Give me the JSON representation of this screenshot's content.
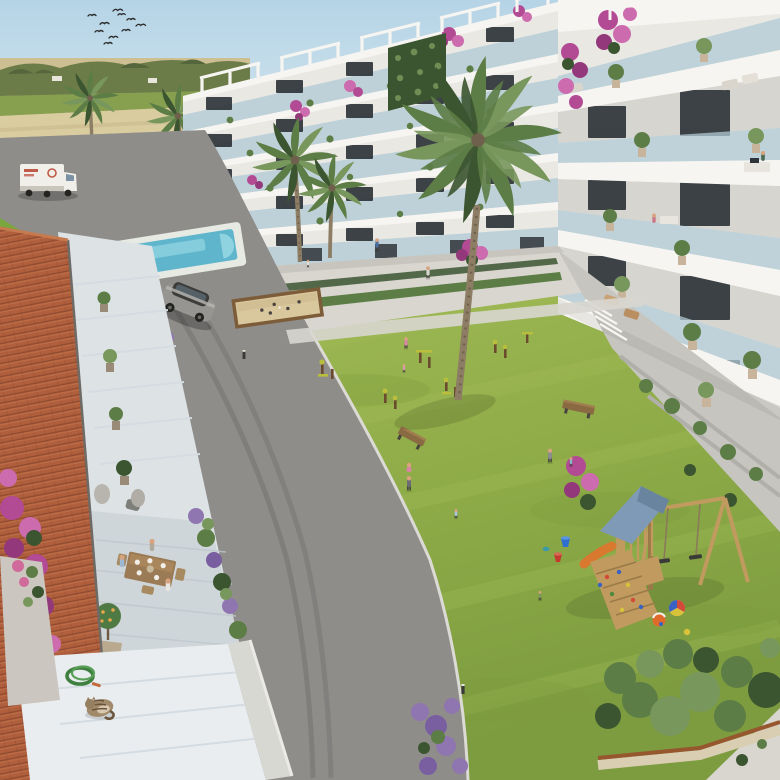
{
  "scene": {
    "type": "architectural-rendering",
    "description": "Aerial 3D visualization of a Mediterranean apartment complex: white modern blocks with glass balconies wrap a large lawn courtyard with palm trees, outdoor gym, bocce court, wooden playground, swimming pool, curving asphalt road with an SUV and delivery truck, farmland horizon with a flock of birds, and a foreground terracotta-roof terrace where three people dine; a cat sleeps beside a coiled garden hose.",
    "objects": [
      "flock-of-birds",
      "wheat-fields",
      "tree-line",
      "cypress-hedge",
      "distant-palms",
      "delivery-truck",
      "ornamental-garden",
      "swimming-pool",
      "swimmers",
      "apartment-building-left-wing",
      "apartment-building-right-wing",
      "roof-pergolas",
      "bougainvillea",
      "balcony-residents",
      "ground-terraces",
      "asphalt-road",
      "suv-car",
      "bocce-court",
      "courtyard-lawn",
      "outdoor-gym-stations",
      "wooden-benches",
      "residents-on-lawn",
      "playground-tower",
      "swing-set",
      "climbing-wall",
      "slide",
      "beach-balls",
      "buckets",
      "shrub-border",
      "lavender",
      "terracotta-roof",
      "dining-terrace",
      "diners",
      "citrus-tree-pot",
      "garden-hose",
      "sleeping-cat",
      "big-palm-tree"
    ],
    "counts": {
      "birds": 10,
      "people_visible": 18,
      "palm_trees": 6,
      "exercise_stations": 6,
      "benches": 2
    }
  },
  "colors": {
    "sky": "#b5d4e6",
    "skyHorizon": "#d9e8ef",
    "fieldTan": "#cdbf92",
    "fieldTanLight": "#d9cc9f",
    "fieldGreen": "#87a050",
    "treeline": "#6c7c49",
    "treelineDark": "#55663c",
    "cypress": "#3c5a33",
    "cypressDark": "#2e4a28",
    "road": "#8e8d8a",
    "roadTop": "#9f9e9b",
    "roadDark": "#73726f",
    "curb": "#dcdad4",
    "gardenGrass": "#7aa63e",
    "hedgeSwirl": "#5d8c31",
    "swirlPath": "#cfdc9f",
    "pool": "#5fb6cc",
    "poolLight": "#8fd2e0",
    "poolDeck": "#e7e9e3",
    "white": "#f6f5f1",
    "wall": "#e9e8e3",
    "wallShade": "#d6d5cf",
    "glass": "#b2cbd6",
    "windowDark": "#2f353a",
    "concrete": "#c6c5c0",
    "planterWall": "#b0afaa",
    "bougainvillea": "#b24a94",
    "bougainvilleaLight": "#cc6bae",
    "bougainvilleaDeep": "#93397b",
    "foliageDark": "#3c5531",
    "foliage": "#5d7d46",
    "foliageLight": "#78975c",
    "grass": "#90ad49",
    "grassLight": "#a3bd58",
    "grassDark": "#7d9c3f",
    "path": "#d8d6cf",
    "sand": "#d9c79e",
    "sandBorder": "#7d5c39",
    "wood": "#c09a5f",
    "woodDark": "#9a7a48",
    "playRoof": "#7e9ab6",
    "playRoofDark": "#69849e",
    "slide": "#d9782f",
    "trunk": "#8d7d64",
    "trunkDark": "#6e604c",
    "roofTile": "#b05f3c",
    "roofTileDark": "#8f4a30",
    "roofTileLight": "#c67a50",
    "marble": "#e9edf0",
    "marbleLine": "#d4dce2",
    "stone": "#cbc6bf",
    "terrace": "#dde2e5",
    "terraceTile": "#cfd6da",
    "tableWood": "#9b7b55",
    "benchWood": "#8a6a42",
    "carBody": "#979591",
    "carDark": "#3c3c3a",
    "carGlass": "#566067",
    "truckWhite": "#f1efe9",
    "truckLogo": "#c05a49",
    "equipBrown": "#6b4a2e",
    "equipYellow": "#b9bf3c",
    "bucketBlue": "#2f6fd0",
    "bucketRed": "#c33b2f",
    "ballOrange": "#e06a2a",
    "ballRed": "#d24a3a",
    "ballBlue": "#3a62c2",
    "ballYellow": "#d8c23a",
    "skin": "#d8a37e",
    "lavender": "#8f76b0",
    "lavenderDeep": "#7a5fa0",
    "corten": "#96562e",
    "gravel": "#d9cdb2",
    "hose": "#3f7f3f",
    "bird": "#2a2a2a"
  }
}
